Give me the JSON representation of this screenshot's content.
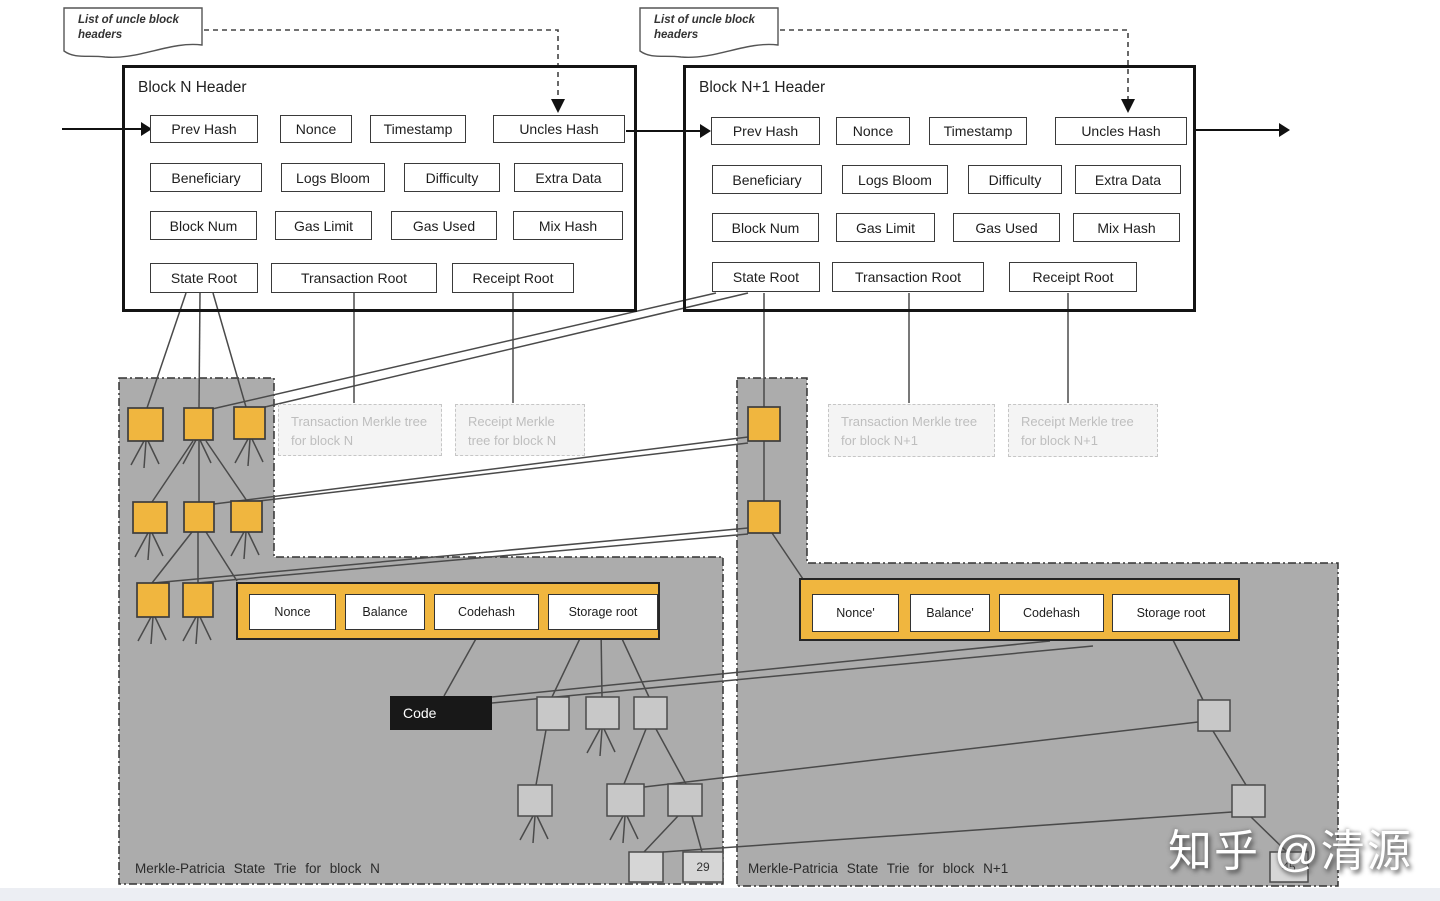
{
  "notes": {
    "n": {
      "text": "List of uncle block headers"
    },
    "n1": {
      "text": "List of uncle block headers"
    }
  },
  "block_n": {
    "title": "Block N Header",
    "prev_hash": "Prev Hash",
    "nonce": "Nonce",
    "timestamp": "Timestamp",
    "uncles_hash": "Uncles Hash",
    "beneficiary": "Beneficiary",
    "logs_bloom": "Logs Bloom",
    "difficulty": "Difficulty",
    "extra_data": "Extra Data",
    "block_num": "Block Num",
    "gas_limit": "Gas Limit",
    "gas_used": "Gas Used",
    "mix_hash": "Mix Hash",
    "state_root": "State Root",
    "transaction_root": "Transaction Root",
    "receipt_root": "Receipt Root"
  },
  "block_n1": {
    "title": "Block N+1 Header",
    "prev_hash": "Prev Hash",
    "nonce": "Nonce",
    "timestamp": "Timestamp",
    "uncles_hash": "Uncles Hash",
    "beneficiary": "Beneficiary",
    "logs_bloom": "Logs Bloom",
    "difficulty": "Difficulty",
    "extra_data": "Extra Data",
    "block_num": "Block Num",
    "gas_limit": "Gas Limit",
    "gas_used": "Gas Used",
    "mix_hash": "Mix Hash",
    "state_root": "State Root",
    "transaction_root": "Transaction Root",
    "receipt_root": "Receipt Root"
  },
  "merkle_boxes": {
    "tx_n": "Transaction Merkle tree for block N",
    "receipt_n": "Receipt Merkle tree for block N",
    "tx_n1": "Transaction Merkle tree for block N+1",
    "receipt_n1": "Receipt Merkle tree for block N+1"
  },
  "account_n": {
    "nonce": "Nonce",
    "balance": "Balance",
    "codehash": "Codehash",
    "storage_root": "Storage root"
  },
  "account_n1": {
    "nonce": "Nonce'",
    "balance": "Balance'",
    "codehash": "Codehash",
    "storage_root": "Storage root"
  },
  "code_box": {
    "label": "Code"
  },
  "trie_labels": {
    "n": "Merkle-Patricia State Trie for block N",
    "n1": "Merkle-Patricia State Trie for block N+1"
  },
  "leaf_values": {
    "block_n": "29",
    "block_n1": "45"
  },
  "watermark": {
    "text": "知乎 @清源"
  },
  "colors": {
    "node_yellow": "#F0B63F",
    "region_gray": "#ACACAC",
    "node_gray": "#C8C8C8",
    "leaf_gray": "#D6D6D6",
    "code_black": "#181818"
  }
}
